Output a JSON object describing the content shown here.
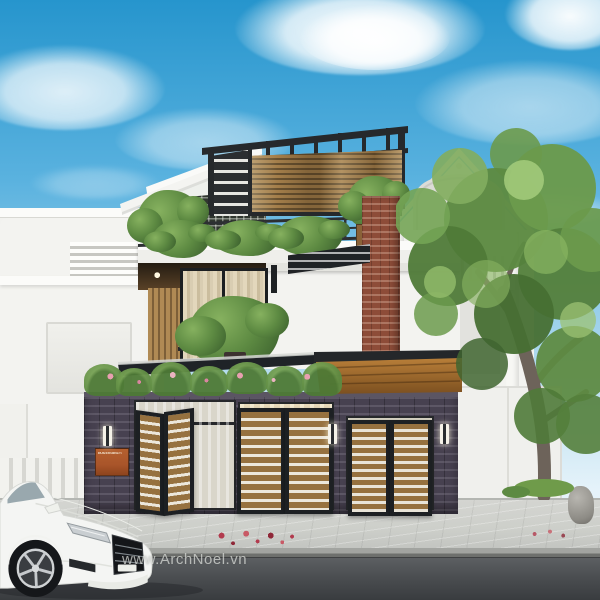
{
  "watermark": {
    "text": "www.ArchNoel.vn"
  },
  "fence": {
    "sign": {
      "line1": "DUC THONG",
      "line2": "HOMESTATION"
    }
  },
  "colors": {
    "sky_top": "#2695cd",
    "sky_mid": "#5ab2df",
    "sky_low": "#b5dcef",
    "white_wall": "#f3f3f0",
    "white_bright": "#fbfbf9",
    "white_shadow": "#d8d8d3",
    "steel": "#26292c",
    "wood": "#96713f",
    "wood_dark": "#67502f",
    "brick_fence": "#474150",
    "brick_red": "#8d4c38",
    "foliage": "#5d8a42",
    "foliage_light": "#86b15f",
    "foliage_dark": "#3f6530",
    "glass_warm": "#e7d9ba",
    "glass_cool": "#d9d6ca",
    "curtain": "#d9cdb2",
    "sign_orange": "#a9552a",
    "sidewalk": "#cdcfca",
    "road": "#4b4e51",
    "car_white": "#f4f5f3",
    "awning": "#202326",
    "petal": "#b23b4e"
  }
}
